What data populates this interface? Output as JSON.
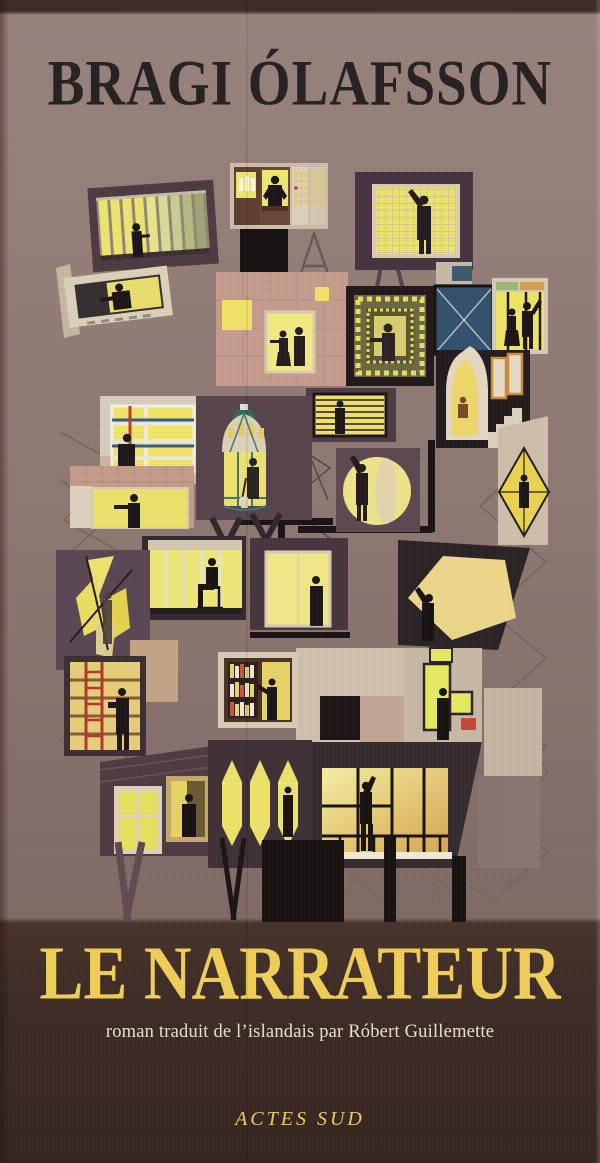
{
  "cover": {
    "author": "BRAGI ÓLAFSSON",
    "title": "LE NARRATEUR",
    "subtitle": "roman traduit de l’islandais par Róbert Guillemette",
    "publisher": "ACTES SUD"
  },
  "colors": {
    "background_top": "#98817b",
    "background_bottom": "#36251f",
    "top_band": "#3b2b26",
    "author_ink": "#241f21",
    "title_gold": "#f2cf56",
    "subtitle_cream": "#ece3d4",
    "publisher_gold": "#f0cd5a",
    "window_yellow": "#f0e76e",
    "panel_plum": "#4e3b43",
    "panel_dark": "#2a2026",
    "cream": "#ddd2bc",
    "pink_wall": "#c79d8d",
    "denim_blue": "#32506c",
    "accent_red": "#c6463a",
    "silhouette": "#1b1416"
  }
}
